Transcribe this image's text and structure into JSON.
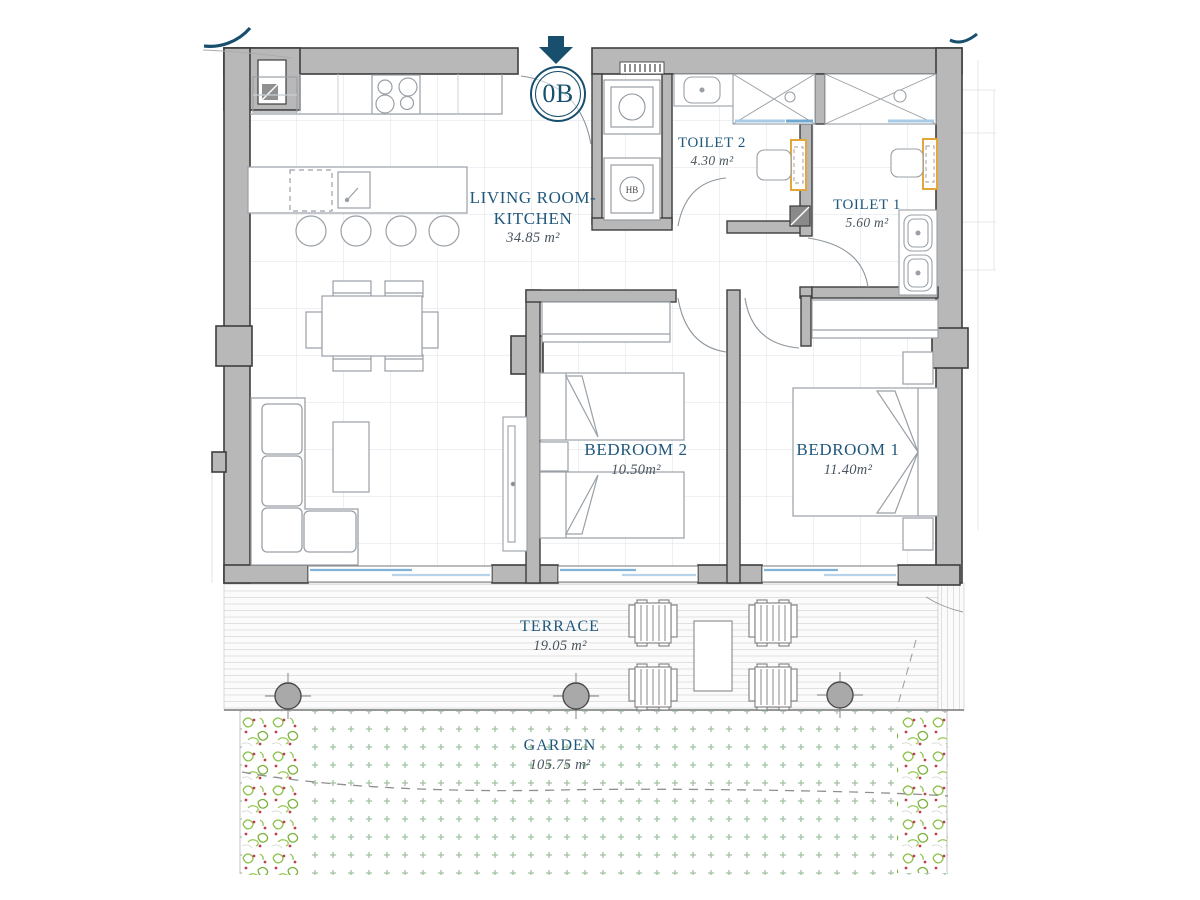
{
  "plan": {
    "unit_label": "0B",
    "rooms": [
      {
        "name": "LIVING ROOM-KITCHEN",
        "area": "34.85 m²"
      },
      {
        "name": "TOILET 2",
        "area": "4.30 m²"
      },
      {
        "name": "TOILET 1",
        "area": "5.60 m²"
      },
      {
        "name": "BEDROOM 2",
        "area": "10.50m²"
      },
      {
        "name": "BEDROOM 1",
        "area": "11.40m²"
      },
      {
        "name": "TERRACE",
        "area": "19.05 m²"
      },
      {
        "name": "GARDEN",
        "area": "105.75 m²"
      }
    ],
    "fixtures": {
      "water_heater_label": "HB"
    },
    "colors": {
      "wall_fill": "#b8b8b8",
      "wall_outline": "#3e3e3e",
      "room_label_blue": "#20587c",
      "area_label_gray": "#49555f",
      "accent_navy": "#174f6d",
      "glazing_blue": "#7fb3da",
      "fixture_yellow": "#e2a63d",
      "garden_cross_green": "#9fc3a0",
      "vegetation_green": "#8abf45",
      "vegetation_red": "#bf4050"
    }
  }
}
